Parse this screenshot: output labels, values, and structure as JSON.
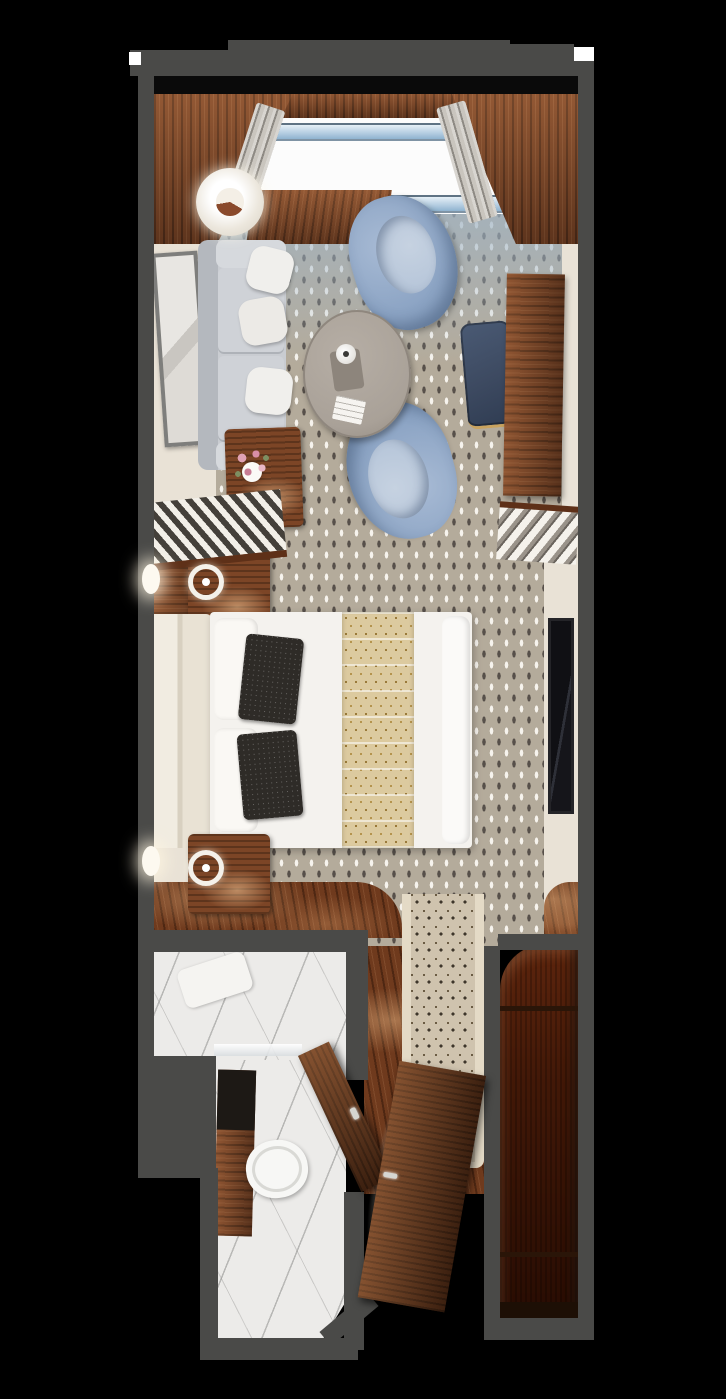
{
  "palette": {
    "background": "#000000",
    "wall": "#4a4a48",
    "wall_shadow": "#0a0a0a",
    "wood_dark": "#5e3018",
    "wood_mid": "#7c4526",
    "wood_light": "#ad6d3e",
    "wood_floor": "#6f3a1d",
    "carpet_base": "#b4ab9b",
    "carpet_window_tint": "#9fb4c6",
    "carpet_dot_light": "#f6f3ed",
    "carpet_dot_dark": "#57504a",
    "runner_base": "#cfc3ae",
    "runner_border": "#e4dac6",
    "runner_dot": "#3e362b",
    "sofa": "#c9ccd1",
    "sofa_back": "#b4b8be",
    "armchair_blue": "#8ca4c4",
    "armchair_seat": "#b8c7da",
    "coffee_table": "#a9a198",
    "desk_chair_navy": "#3d4a61",
    "brass": "#c9a35f",
    "bed_white": "#f4f2ee",
    "headboard_cream": "#efe9dc",
    "runner_tan": "#dcca9f",
    "runner_tan_dot": "#9a7a3a",
    "pillow_dark": "#2e2b27",
    "marble": "#ecebe9",
    "marble_vein": "#a9a9a7",
    "glass_blue": "#b7cfe2",
    "balcony_white": "#fcfcfc",
    "cream_wall": "#e9e2d6",
    "tv_black": "#15151a",
    "lamp_white": "#f6f3ec",
    "flower_pink": "#e0a2b4",
    "flower_green": "#7d8f62",
    "curtain_gray": "#b8b4ad"
  },
  "areas": {
    "balcony": {
      "title": "Balcony with glass railing"
    },
    "living": {
      "title": "Living area"
    },
    "bedroom": {
      "title": "Bedroom"
    },
    "bathroom": {
      "title": "Bathroom"
    },
    "entry": {
      "title": "Entry hall"
    },
    "closet": {
      "title": "Walk-in closet"
    }
  },
  "furniture": {
    "sofa": {
      "title": "Sofa with throw pillows"
    },
    "floor_lamp": {
      "title": "Floor lamp"
    },
    "console": {
      "title": "Wood console table"
    },
    "armchair_top": {
      "title": "Blue swivel armchair"
    },
    "armchair_bottom": {
      "title": "Blue swivel armchair"
    },
    "coffee_table": {
      "title": "Round coffee table with tea set"
    },
    "desk": {
      "title": "Writing desk"
    },
    "desk_chair": {
      "title": "Desk chair"
    },
    "artwork": {
      "title": "Framed artwork"
    },
    "flower_table": {
      "title": "Side table with flowers"
    },
    "wardrobe_left": {
      "title": "Open shelving unit"
    },
    "wardrobe_right": {
      "title": "Open shelving unit"
    },
    "nightstand_top": {
      "title": "Nightstand with lamp"
    },
    "nightstand_bottom": {
      "title": "Nightstand with lamp"
    },
    "bed": {
      "title": "Queen bed with runner"
    },
    "headboard": {
      "title": "Upholstered headboard"
    },
    "tv": {
      "title": "Wall-mounted TV"
    },
    "shower": {
      "title": "Marble shower"
    },
    "vanity": {
      "title": "Bathroom vanity"
    },
    "toilet": {
      "title": "Toilet"
    },
    "bathroom_door": {
      "title": "Bathroom door"
    },
    "entry_door": {
      "title": "Entry door"
    },
    "hall_runner": {
      "title": "Hallway carpet runner"
    },
    "closet_shelves": {
      "title": "Closet shelves"
    }
  }
}
